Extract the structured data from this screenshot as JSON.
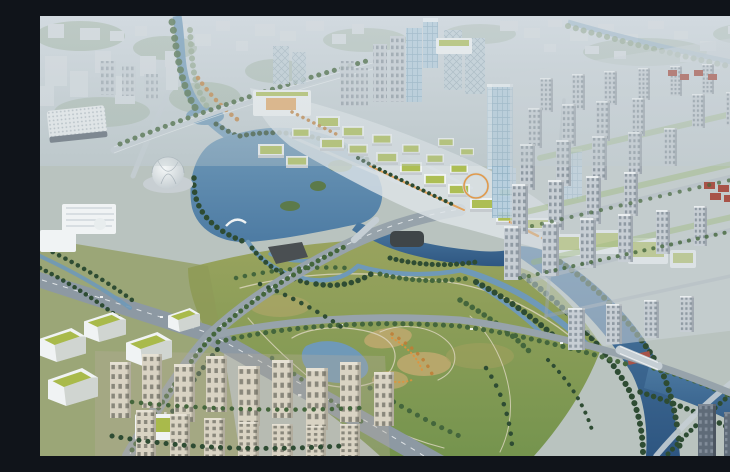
{
  "scene": {
    "type": "aerial-architectural-rendering",
    "description": "Bird's-eye rendering of an urban masterplan: a central lake and wetland park surrounded by a low-rise commercial district with green roofs and orange walkways, glass office towers, dense grey apartment grids to the east, cream residential towers and terraced green-roof offices to the southwest, a large landscaped park with a pond, and a dark blue river curving through the southeast corner.",
    "visible_text": "none"
  },
  "palette": {
    "haze": "#d2dae0",
    "hazeLow": "#bdc8cb",
    "distantBlock": "#d6dce0",
    "distantShadow": "#aeb9c0",
    "mutedGreen": "#93a98e",
    "waterLight": "#6f99b8",
    "water": "#4d7ba3",
    "waterDeep": "#2e5681",
    "parkOlive": "#99a35e",
    "parkGreen": "#75944e",
    "parkTan": "#b7a76b",
    "treeDark": "#2e4c33",
    "treeMid": "#44663c",
    "treeAutumn": "#c07c34",
    "road": "#97a3ab",
    "roadLight": "#c5ced4",
    "white": "#f0f3f4",
    "roofGreen": "#a9ba4b",
    "orange": "#e2923b",
    "glass": "#b5cede",
    "glassDark": "#8fb0c4",
    "towerGrey": "#c7ced4",
    "towerWin": "#8f9aa3",
    "cream": "#d9d3c3",
    "creamWin": "#7c7a6e",
    "roofRed": "#a85348",
    "darkTower": "#5f6b78"
  }
}
